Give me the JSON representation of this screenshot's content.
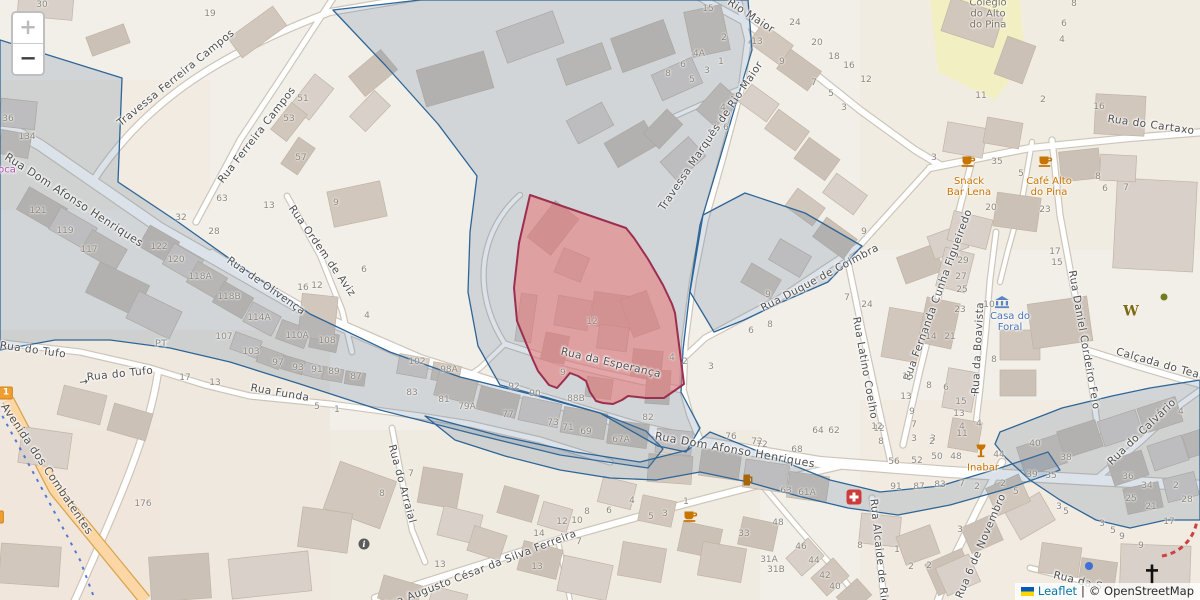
{
  "map": {
    "zoom_control": {
      "zoom_in_label": "+",
      "zoom_out_label": "−"
    },
    "attribution": {
      "leaflet_label": "Leaflet",
      "separator": "|",
      "osm_label": "© OpenStreetMap"
    },
    "colors": {
      "land": "#f2efe9",
      "boundary_stroke": "#2e6596",
      "boundary_fill": "rgba(92,121,153,0.22)",
      "highlight_stroke": "#9c2f50",
      "highlight_fill": "rgba(233,116,116,0.55)",
      "primary_road": "#fcd6a4",
      "poi_amenity": "#c77400",
      "poi_civic": "#4a72b8",
      "school_area": "#f2efc3"
    },
    "street_labels": [
      {
        "t": "Travessa Ferreira Campos",
        "x": 176,
        "y": 78,
        "r": -39
      },
      {
        "t": "Rua Ferreira Campos",
        "x": 257,
        "y": 135,
        "r": -52
      },
      {
        "t": "Rua Dom Afonso Henriques",
        "x": 74,
        "y": 200,
        "r": 33,
        "s": 11
      },
      {
        "t": "Rua Dom Afonso Henriques",
        "x": 735,
        "y": 450,
        "r": 10,
        "s": 11
      },
      {
        "t": "Rua Ordem de Aviz",
        "x": 322,
        "y": 251,
        "r": 55
      },
      {
        "t": "Rua de Olivença",
        "x": 266,
        "y": 286,
        "r": 35
      },
      {
        "t": "Rua do Tufo",
        "x": 33,
        "y": 350,
        "r": 8
      },
      {
        "t": "→",
        "n": "oneway-arrow-icon",
        "x": 84,
        "y": 382,
        "r": -8
      },
      {
        "t": "Rua do Tufo",
        "x": 120,
        "y": 374,
        "r": -6
      },
      {
        "t": "Rua Funda",
        "x": 280,
        "y": 393,
        "r": 10
      },
      {
        "t": "Avenida dos Combatentes",
        "x": 47,
        "y": 469,
        "r": 56,
        "s": 11
      },
      {
        "t": "Rua da Esperança",
        "x": 611,
        "y": 363,
        "r": 13
      },
      {
        "t": "Travessa Marquês de Rio Maior",
        "x": 711,
        "y": 136,
        "r": -56
      },
      {
        "t": "Rio Maior",
        "x": 751,
        "y": 16,
        "r": 33
      },
      {
        "t": "Rua Duque de Coimbra",
        "x": 820,
        "y": 278,
        "r": -28
      },
      {
        "t": "Rua Latino Coelho",
        "x": 865,
        "y": 368,
        "r": 80
      },
      {
        "t": "Rua Fernanda Cunha Figueiredo",
        "x": 938,
        "y": 295,
        "r": -70
      },
      {
        "t": "→",
        "n": "oneway-arrow-icon",
        "x": 975,
        "y": 392,
        "r": -87
      },
      {
        "t": "Rua da Boavista",
        "x": 978,
        "y": 348,
        "r": -87
      },
      {
        "t": "Rua Daniel Cordeiro Feio",
        "x": 1084,
        "y": 340,
        "r": 80
      },
      {
        "t": "Rua do Cartaxo",
        "x": 1151,
        "y": 125,
        "r": 8
      },
      {
        "t": "Calçada do Teat",
        "x": 1160,
        "y": 364,
        "r": 16
      },
      {
        "t": "Rua do Calvário",
        "x": 1142,
        "y": 432,
        "r": -44
      },
      {
        "t": "Rua 6 de Novembro",
        "x": 981,
        "y": 546,
        "r": -67
      },
      {
        "t": "Rua Alcaide de Rio",
        "x": 879,
        "y": 552,
        "r": 84
      },
      {
        "t": "Rua Augusto César da Silva Ferreira",
        "x": 480,
        "y": 570,
        "r": -21
      },
      {
        "t": "Rua do Arraial",
        "x": 402,
        "y": 484,
        "r": 75
      },
      {
        "t": "Rua da S",
        "x": 1078,
        "y": 581,
        "r": 14
      }
    ],
    "poi_labels": [
      {
        "lines": [
          "Snack",
          "Bar Lena"
        ],
        "x": 969,
        "y": 187,
        "color": "#c77400"
      },
      {
        "lines": [
          "Café Alto",
          "do Pina"
        ],
        "x": 1049,
        "y": 187,
        "color": "#c77400"
      },
      {
        "lines": [
          "Inabar"
        ],
        "x": 983,
        "y": 468,
        "color": "#c77400"
      },
      {
        "lines": [
          "Casa do",
          "Foral"
        ],
        "x": 1010,
        "y": 322,
        "color": "#4a72b8"
      },
      {
        "lines": [
          "Colégio",
          "do Alto",
          "do Pina"
        ],
        "x": 988,
        "y": 14,
        "color": "#77705e"
      },
      {
        "lines": [
          "oca"
        ],
        "x": 7,
        "y": 170,
        "color": "#b94fb9"
      },
      {
        "lines": [
          "PT"
        ],
        "x": 161,
        "y": 344,
        "color": "#8a8a8a"
      }
    ],
    "poi_icons": [
      {
        "icon": "cafe-cup",
        "x": 969,
        "y": 161
      },
      {
        "icon": "cafe-cup",
        "x": 1046,
        "y": 161
      },
      {
        "icon": "cafe-cup",
        "x": 691,
        "y": 516
      },
      {
        "icon": "beer-mug",
        "x": 748,
        "y": 480
      },
      {
        "icon": "wine-goblet",
        "x": 981,
        "y": 451
      },
      {
        "icon": "hospital-cross",
        "x": 854,
        "y": 497
      },
      {
        "icon": "museum-building",
        "x": 1002,
        "y": 302
      },
      {
        "icon": "letter-w",
        "x": 1131,
        "y": 311
      },
      {
        "icon": "info-circle",
        "x": 364,
        "y": 544
      },
      {
        "icon": "church-cross",
        "x": 1152,
        "y": 574
      },
      {
        "icon": "tree-dot",
        "x": 1164,
        "y": 297
      },
      {
        "icon": "blue-dot",
        "x": 1089,
        "y": 566
      }
    ],
    "route_shields": [
      {
        "text": "1",
        "x": 6,
        "y": 393
      },
      {
        "text": "0",
        "x": -3,
        "y": 517
      }
    ],
    "house_numbers": [
      [
        "30",
        42,
        5
      ],
      [
        "19",
        210,
        14
      ],
      [
        "51",
        303,
        99
      ],
      [
        "53",
        289,
        119
      ],
      [
        "57",
        301,
        158
      ],
      [
        "36",
        8,
        119
      ],
      [
        "134",
        27,
        137
      ],
      [
        "121",
        38,
        211
      ],
      [
        "119",
        65,
        231
      ],
      [
        "117",
        89,
        250
      ],
      [
        "122",
        159,
        247
      ],
      [
        "120",
        176,
        260
      ],
      [
        "118A",
        200,
        277
      ],
      [
        "118B",
        229,
        297
      ],
      [
        "114A",
        259,
        318
      ],
      [
        "110A",
        297,
        336
      ],
      [
        "108",
        327,
        341
      ],
      [
        "32",
        181,
        218
      ],
      [
        "28",
        214,
        232
      ],
      [
        "63",
        222,
        199
      ],
      [
        "13",
        269,
        206
      ],
      [
        "9",
        336,
        203
      ],
      [
        "16",
        303,
        288
      ],
      [
        "12",
        317,
        286
      ],
      [
        "6",
        364,
        270
      ],
      [
        "4",
        367,
        316
      ],
      [
        "107",
        224,
        337
      ],
      [
        "103",
        251,
        352
      ],
      [
        "97",
        278,
        363
      ],
      [
        "93",
        298,
        368
      ],
      [
        "91",
        317,
        370
      ],
      [
        "89",
        334,
        372
      ],
      [
        "87",
        356,
        377
      ],
      [
        "102",
        417,
        362
      ],
      [
        "98A",
        449,
        370
      ],
      [
        "83",
        412,
        393
      ],
      [
        "81",
        444,
        400
      ],
      [
        "79A",
        467,
        407
      ],
      [
        "77",
        508,
        415
      ],
      [
        "73",
        553,
        423
      ],
      [
        "71",
        568,
        428
      ],
      [
        "69",
        586,
        432
      ],
      [
        "67A",
        621,
        440
      ],
      [
        "92",
        514,
        387
      ],
      [
        "90",
        535,
        394
      ],
      [
        "88B",
        576,
        399
      ],
      [
        "82",
        648,
        418
      ],
      [
        "76",
        731,
        437
      ],
      [
        "72",
        757,
        442
      ],
      [
        "17",
        185,
        378
      ],
      [
        "13",
        215,
        383
      ],
      [
        "5",
        317,
        407
      ],
      [
        "1",
        337,
        410
      ],
      [
        "12",
        592,
        322
      ],
      [
        "9",
        563,
        373
      ],
      [
        "4",
        672,
        358
      ],
      [
        "2",
        685,
        362
      ],
      [
        "3",
        711,
        367
      ],
      [
        "15",
        708,
        9
      ],
      [
        "2",
        724,
        38
      ],
      [
        "4A",
        699,
        54
      ],
      [
        "1",
        721,
        62
      ],
      [
        "3",
        707,
        71
      ],
      [
        "8",
        668,
        74
      ],
      [
        "6",
        683,
        65
      ],
      [
        "5",
        692,
        80
      ],
      [
        "4",
        723,
        108
      ],
      [
        "6",
        726,
        128
      ],
      [
        "13",
        757,
        42
      ],
      [
        "9",
        782,
        62
      ],
      [
        "7",
        814,
        83
      ],
      [
        "5",
        831,
        94
      ],
      [
        "3",
        844,
        108
      ],
      [
        "24",
        795,
        23
      ],
      [
        "20",
        817,
        43
      ],
      [
        "18",
        834,
        57
      ],
      [
        "16",
        849,
        66
      ],
      [
        "12",
        866,
        80
      ],
      [
        "9",
        864,
        232
      ],
      [
        "9",
        768,
        295
      ],
      [
        "8",
        770,
        325
      ],
      [
        "6",
        751,
        331
      ],
      [
        "7",
        847,
        298
      ],
      [
        "24",
        867,
        305
      ],
      [
        "29",
        963,
        261
      ],
      [
        "27",
        961,
        277
      ],
      [
        "25",
        962,
        290
      ],
      [
        "23",
        960,
        310
      ],
      [
        "14",
        931,
        337
      ],
      [
        "21",
        950,
        337
      ],
      [
        "15",
        908,
        377
      ],
      [
        "13",
        906,
        397
      ],
      [
        "9",
        912,
        412
      ],
      [
        "12",
        879,
        429
      ],
      [
        "3",
        933,
        439
      ],
      [
        "8",
        929,
        386
      ],
      [
        "6",
        946,
        388
      ],
      [
        "15",
        961,
        402
      ],
      [
        "13",
        959,
        414
      ],
      [
        "4",
        962,
        427
      ],
      [
        "10",
        989,
        305
      ],
      [
        "8",
        994,
        360
      ],
      [
        "17",
        1055,
        252
      ],
      [
        "15",
        1057,
        263
      ],
      [
        "64",
        818,
        431
      ],
      [
        "62",
        834,
        431
      ],
      [
        "68",
        797,
        450
      ],
      [
        "72",
        762,
        445
      ],
      [
        "8",
        1074,
        4
      ],
      [
        "6",
        1064,
        24
      ],
      [
        "4",
        1062,
        40
      ],
      [
        "11",
        981,
        96
      ],
      [
        "2",
        1043,
        100
      ],
      [
        "16",
        1099,
        107
      ],
      [
        "3",
        934,
        158
      ],
      [
        "35",
        997,
        162
      ],
      [
        "5",
        1021,
        174
      ],
      [
        "20",
        991,
        208
      ],
      [
        "23",
        1045,
        210
      ],
      [
        "8",
        1098,
        177
      ],
      [
        "6",
        1105,
        189
      ],
      [
        "7",
        1126,
        188
      ],
      [
        "12",
        877,
        427
      ],
      [
        "7",
        914,
        425
      ],
      [
        "8",
        881,
        442
      ],
      [
        "3",
        914,
        439
      ],
      [
        "2",
        932,
        442
      ],
      [
        "50",
        937,
        457
      ],
      [
        "48",
        956,
        457
      ],
      [
        "56",
        894,
        462
      ],
      [
        "52",
        917,
        461
      ],
      [
        "11",
        962,
        434
      ],
      [
        "4",
        979,
        424
      ],
      [
        "44",
        999,
        455
      ],
      [
        "40",
        1035,
        444
      ],
      [
        "38",
        1066,
        458
      ],
      [
        "39",
        1032,
        475
      ],
      [
        "35",
        1051,
        476
      ],
      [
        "91",
        896,
        487
      ],
      [
        "87",
        919,
        487
      ],
      [
        "83",
        940,
        485
      ],
      [
        "7",
        962,
        484
      ],
      [
        "2",
        977,
        487
      ],
      [
        "61A",
        807,
        493
      ],
      [
        "63",
        786,
        491
      ],
      [
        "4",
        632,
        501
      ],
      [
        "8",
        587,
        512
      ],
      [
        "6",
        609,
        511
      ],
      [
        "5",
        651,
        517
      ],
      [
        "3",
        665,
        514
      ],
      [
        "1",
        686,
        502
      ],
      [
        "12",
        562,
        522
      ],
      [
        "10",
        577,
        521
      ],
      [
        "7",
        579,
        542
      ],
      [
        "14",
        539,
        534
      ],
      [
        "13",
        537,
        567
      ],
      [
        "13",
        440,
        565
      ],
      [
        "7",
        411,
        474
      ],
      [
        "8",
        382,
        494
      ],
      [
        "33",
        744,
        534
      ],
      [
        "31A",
        769,
        560
      ],
      [
        "31B",
        776,
        570
      ],
      [
        "48",
        778,
        523
      ],
      [
        "46",
        801,
        547
      ],
      [
        "44",
        814,
        561
      ],
      [
        "42",
        825,
        576
      ],
      [
        "40",
        835,
        587
      ],
      [
        "5",
        1016,
        492
      ],
      [
        "2",
        1003,
        484
      ],
      [
        "3",
        960,
        530
      ],
      [
        "8",
        860,
        546
      ],
      [
        "1",
        897,
        550
      ],
      [
        "2",
        911,
        567
      ],
      [
        "2",
        929,
        566
      ],
      [
        "5",
        1066,
        512
      ],
      [
        "3",
        1059,
        507
      ],
      [
        "4",
        1181,
        412
      ],
      [
        "36",
        1128,
        477
      ],
      [
        "34",
        1147,
        486
      ],
      [
        "2",
        1176,
        486
      ],
      [
        "25",
        1131,
        499
      ],
      [
        "21",
        1151,
        507
      ],
      [
        "28",
        1187,
        500
      ],
      [
        "17",
        1169,
        522
      ],
      [
        "3",
        1102,
        524
      ],
      [
        "5",
        1113,
        531
      ],
      [
        "9",
        1122,
        537
      ],
      [
        "9",
        1141,
        546
      ],
      [
        "176",
        143,
        504
      ]
    ]
  }
}
